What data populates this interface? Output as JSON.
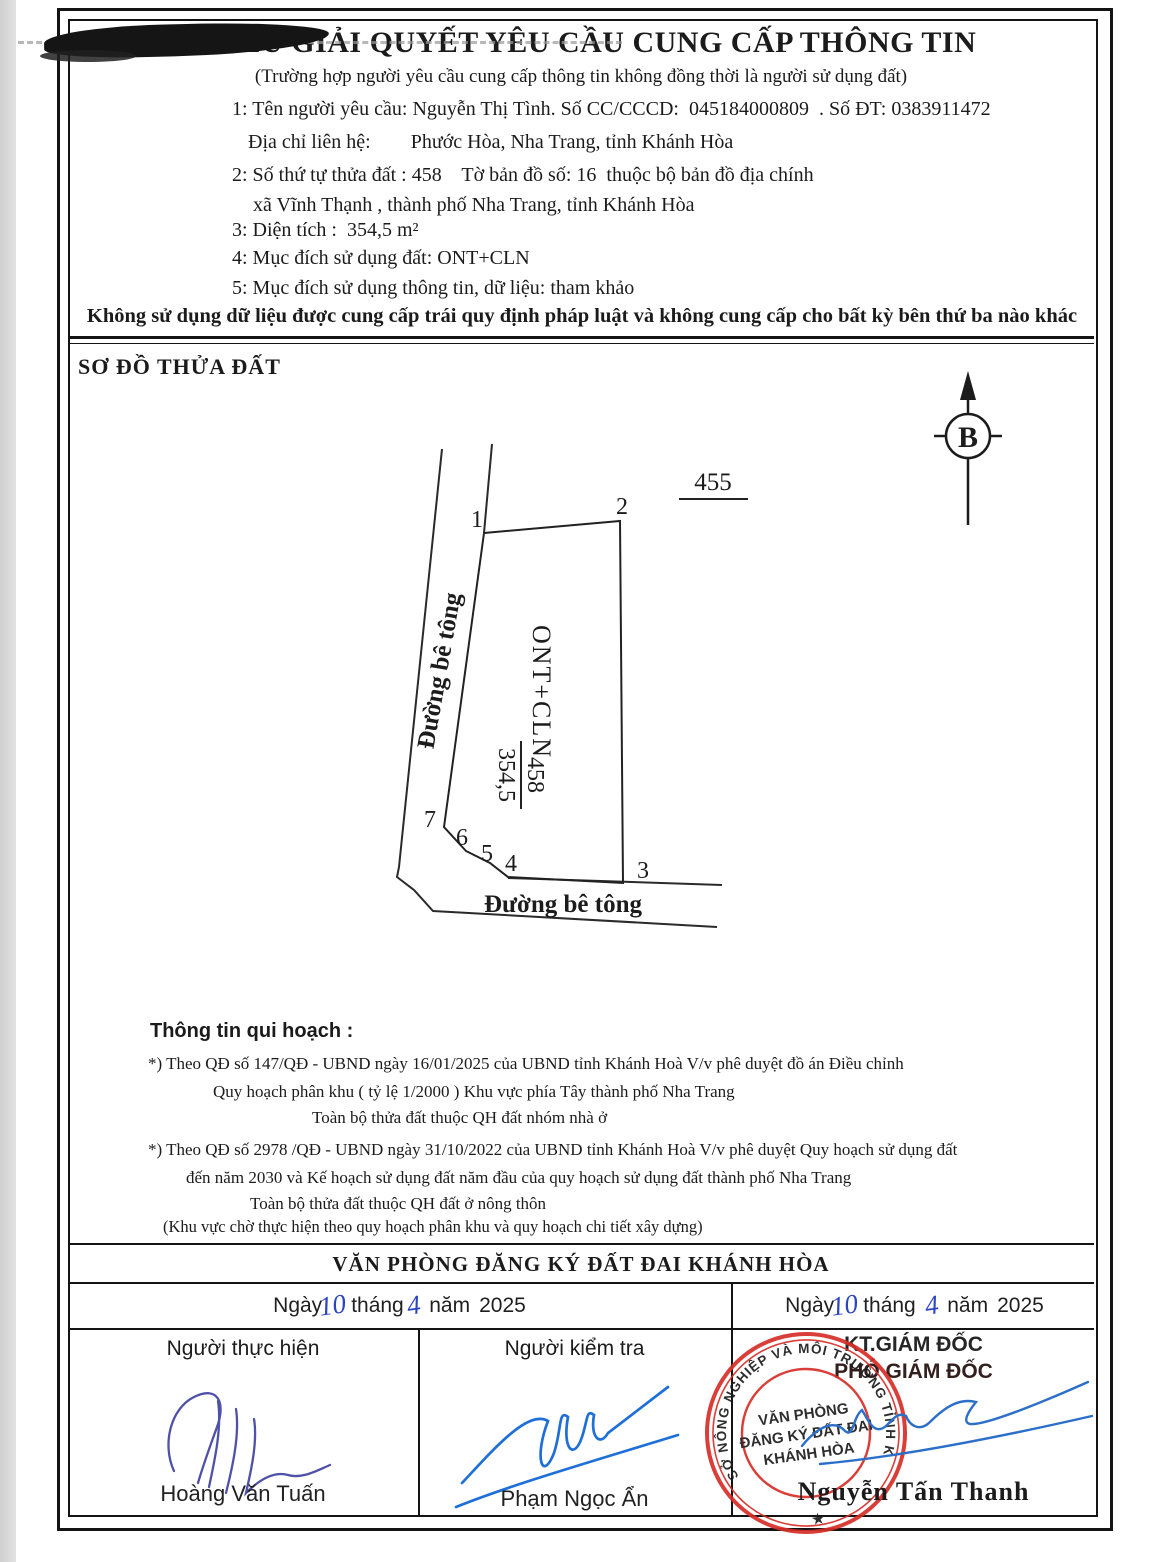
{
  "document": {
    "title": "PHIẾU GIẢI QUYẾT YÊU CẦU CUNG CẤP THÔNG TIN",
    "subtitle": "(Trường hợp người yêu cầu cung cấp thông tin không đồng thời là người sử dụng đất)",
    "info_lines": [
      "1: Tên người yêu cầu: Nguyễn Thị Tình. Số CC/CCCD:  045184000809  . Số ĐT: 0383911472",
      "Địa chỉ liên hệ:        Phước Hòa, Nha Trang, tỉnh Khánh Hòa",
      "2: Số thứ tự thửa đất : 458    Tờ bản đồ số: 16  thuộc bộ bản đồ địa chính",
      "xã Vĩnh Thạnh , thành phố Nha Trang, tỉnh Khánh Hòa",
      "3: Diện tích :  354,5 m²",
      "4: Mục đích sử dụng đất: ONT+CLN",
      "5: Mục đích sử dụng thông tin, dữ liệu: tham khảo"
    ],
    "warning": "Không sử dụng dữ liệu được cung cấp trái quy định pháp luật và không cung cấp cho bất kỳ bên thứ ba nào khác"
  },
  "diagram": {
    "heading": "SƠ ĐỒ THỬA ĐẤT",
    "north_label": "B",
    "adjacent_parcel": "455",
    "road_left_label": "Đường bê tông",
    "road_bottom_label": "Đường bê tông",
    "land_use": "ONT+CLN",
    "parcel_number": "458",
    "parcel_area": "354,5",
    "vertices": [
      "1",
      "2",
      "3",
      "4",
      "5",
      "6",
      "7"
    ]
  },
  "planning": {
    "heading": "Thông tin qui hoạch :",
    "p1": [
      "*) Theo QĐ số 147/QĐ - UBND ngày 16/01/2025 của UBND tỉnh Khánh Hoà V/v phê duyệt đồ án Điều chỉnh",
      "Quy hoạch phân khu ( tỷ lệ 1/2000 ) Khu vực phía Tây thành phố Nha Trang",
      "Toàn bộ thửa đất thuộc QH đất nhóm nhà ở"
    ],
    "p2": [
      "*) Theo QĐ số 2978 /QĐ - UBND ngày 31/10/2022 của UBND tỉnh Khánh Hoà V/v phê duyệt Quy hoạch sử dụng đất",
      "đến năm 2030 và Kế hoạch sử dụng đất năm đầu của quy hoạch sử dụng đất thành phố Nha Trang",
      "Toàn bộ thửa đất thuộc QH đất ở nông thôn",
      "(Khu vực chờ thực hiện theo quy hoạch phân khu và quy hoạch chi tiết xây dựng)"
    ]
  },
  "footer": {
    "office": "VĂN PHÒNG ĐĂNG KÝ ĐẤT ĐAI KHÁNH HÒA",
    "date_left": {
      "d1": "Ngày",
      "day": "10",
      "d2": "tháng",
      "month": "4",
      "d3": "năm",
      "year": "2025"
    },
    "date_right": {
      "d1": "Ngày",
      "day": "10",
      "d2": "tháng",
      "month": "4",
      "d3": "năm",
      "year": "2025"
    },
    "col1": {
      "role": "Người thực hiện",
      "name": "Hoàng Văn Tuấn"
    },
    "col2": {
      "role": "Người kiểm tra",
      "name": "Phạm Ngọc Ẩn"
    },
    "col3": {
      "role1": "KT.GIÁM ĐỐC",
      "role2": "PHÓ GIÁM ĐỐC",
      "name": "Nguyễn Tấn Thanh"
    },
    "stamp": {
      "ring": "SỞ NÔNG NGHIỆP VÀ MÔI TRƯỜNG TỈNH KHÁNH HÒA",
      "star": "★",
      "line1": "VĂN PHÒNG",
      "line2": "ĐĂNG KÝ ĐẤT ĐAI",
      "line3": "KHÁNH HÒA"
    }
  },
  "colors": {
    "stamp_red": "#d62f28",
    "signature_blue": "#1f6fd8",
    "signature_purple": "#4f51a8",
    "handwriting_blue": "#2b44c4",
    "ink": "#1b1b1b"
  }
}
